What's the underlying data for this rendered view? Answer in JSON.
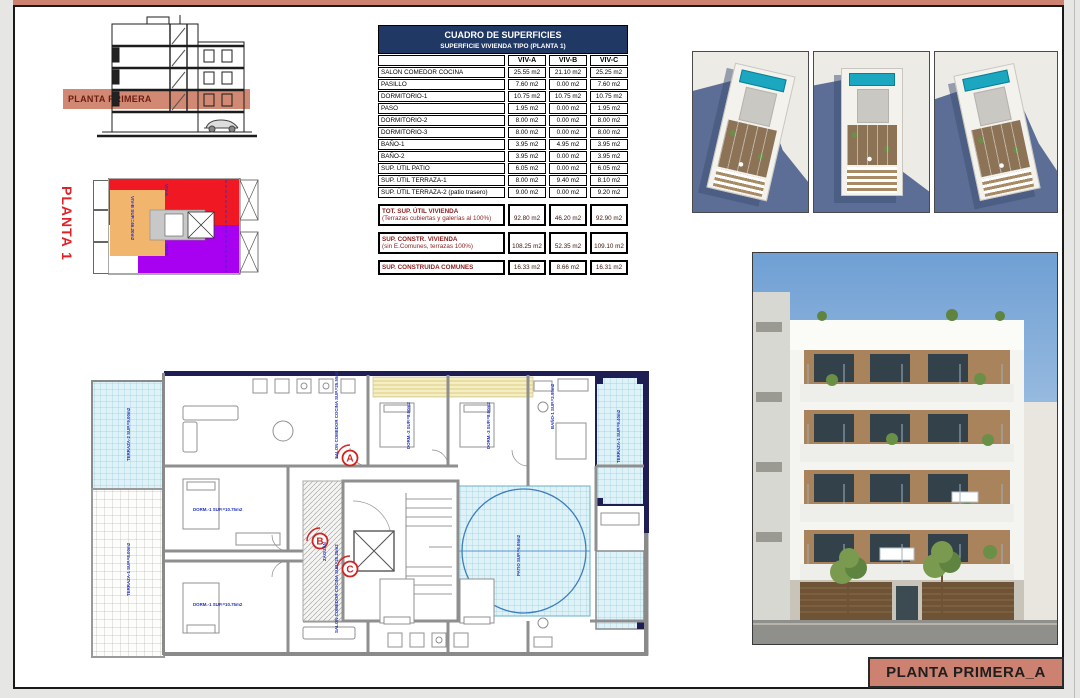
{
  "accent_color": "#cd8170",
  "section": {
    "band_label": "PLANTA PRIMERA"
  },
  "key_plan": {
    "title": "PLANTA 1",
    "unit_labels": [
      {
        "text": "VIV-A",
        "x": 124,
        "y": 16
      },
      {
        "text": "VIV-B SUP.=46.20m2",
        "x": 90,
        "y": 28
      },
      {
        "text": "VIV-C",
        "x": 124,
        "y": 76
      }
    ],
    "colors": {
      "viv_a": "#f01823",
      "viv_b": "#f2b56e",
      "viv_c": "#a800f0"
    }
  },
  "table": {
    "title": "CUADRO DE SUPERFICIES",
    "subtitle": "SUPERFICIE VIVIENDA TIPO  (PLANTA 1)",
    "columns": [
      "VIV-A",
      "VIV-B",
      "VIV-C"
    ],
    "rows": [
      {
        "label": "SALON COMEDOR COCINA",
        "values": [
          "25.55 m2",
          "21.10 m2",
          "25.25 m2"
        ]
      },
      {
        "label": "PASILLO",
        "values": [
          "7.60 m2",
          "0.00 m2",
          "7.60 m2"
        ]
      },
      {
        "label": "DORMITORIO-1",
        "values": [
          "10.75 m2",
          "10.75 m2",
          "10.75 m2"
        ]
      },
      {
        "label": "PASO",
        "values": [
          "1.95 m2",
          "0.00 m2",
          "1.95 m2"
        ]
      },
      {
        "label": "DORMITORIO-2",
        "values": [
          "8.00 m2",
          "0.00 m2",
          "8.00 m2"
        ]
      },
      {
        "label": "DORMITORIO-3",
        "values": [
          "8.00 m2",
          "0.00 m2",
          "8.00 m2"
        ]
      },
      {
        "label": "BAÑO-1",
        "values": [
          "3.95 m2",
          "4.95 m2",
          "3.95 m2"
        ]
      },
      {
        "label": "BAÑO-2",
        "values": [
          "3.95 m2",
          "0.00 m2",
          "3.95 m2"
        ]
      },
      {
        "label": "SUP. ÚTIL PATIO",
        "values": [
          "6.05 m2",
          "0.00 m2",
          "6.05 m2"
        ]
      },
      {
        "label": "SUP. ÚTIL TERRAZA-1",
        "values": [
          "8.00 m2",
          "9.40 m2",
          "8.10 m2"
        ]
      },
      {
        "label": "SUP. ÚTIL TERRAZA-2 (patio trasero)",
        "values": [
          "9.00 m2",
          "0.00 m2",
          "9.20 m2"
        ]
      }
    ],
    "summary": [
      {
        "label_lines": [
          "TOT. SUP. ÚTIL VIVIENDA",
          "(Terrazas cubiertas y galerías al 100%)"
        ],
        "values": [
          "92.80 m2",
          "46.20 m2",
          "92.90 m2"
        ]
      },
      {
        "label_lines": [
          "SUP. CONSTR. VIVIENDA",
          "(sin E.Comunes, terrazas 100%)"
        ],
        "values": [
          "108.25 m2",
          "52.35 m2",
          "109.10 m2"
        ]
      },
      {
        "label_lines": [
          "SUP. CONSTRUIDA COMUNES"
        ],
        "values": [
          "16.33 m2",
          "8.66 m2",
          "16.31 m2"
        ]
      }
    ]
  },
  "floor_plan": {
    "badges": [
      {
        "letter": "A",
        "x": 262,
        "y": 87
      },
      {
        "letter": "B",
        "x": 232,
        "y": 170
      },
      {
        "letter": "C",
        "x": 262,
        "y": 198
      }
    ],
    "labels": [
      {
        "t": "SALON COMEDOR COCINA SUP.=25.55m2",
        "x": 250,
        "y": 88,
        "r": -90
      },
      {
        "t": "DORM.-2 SUP.=8.00m2",
        "x": 322,
        "y": 78,
        "r": -90
      },
      {
        "t": "DORM.-3 SUP.=8.00m2",
        "x": 402,
        "y": 78,
        "r": -90
      },
      {
        "t": "BAÑO-1 SUP.=3.95m2",
        "x": 466,
        "y": 58,
        "r": -90
      },
      {
        "t": "TERRAZA-1 SUP.=9.40m2",
        "x": 532,
        "y": 92,
        "r": -90
      },
      {
        "t": "DORM.-1 SUP.=10.75m2",
        "x": 105,
        "y": 140,
        "r": 0
      },
      {
        "t": "PATIO SUP.=6.05m2",
        "x": 432,
        "y": 205,
        "r": -90
      },
      {
        "t": "ZAGUÁN",
        "x": 238,
        "y": 190,
        "r": -90
      },
      {
        "t": "SALON COMEDOR COCINA SUP.=25.25m2",
        "x": 250,
        "y": 262,
        "r": -90
      },
      {
        "t": "DORM.-1 SUP.=10.75m2",
        "x": 105,
        "y": 235,
        "r": 0
      },
      {
        "t": "TERRAZA-2 SUP.=9.00m2",
        "x": 42,
        "y": 90,
        "r": -90
      },
      {
        "t": "TERRAZA-1 SUP.=8.00m2",
        "x": 42,
        "y": 225,
        "r": -90
      }
    ]
  },
  "title_block": {
    "label": "PLANTA PRIMERA_A"
  }
}
